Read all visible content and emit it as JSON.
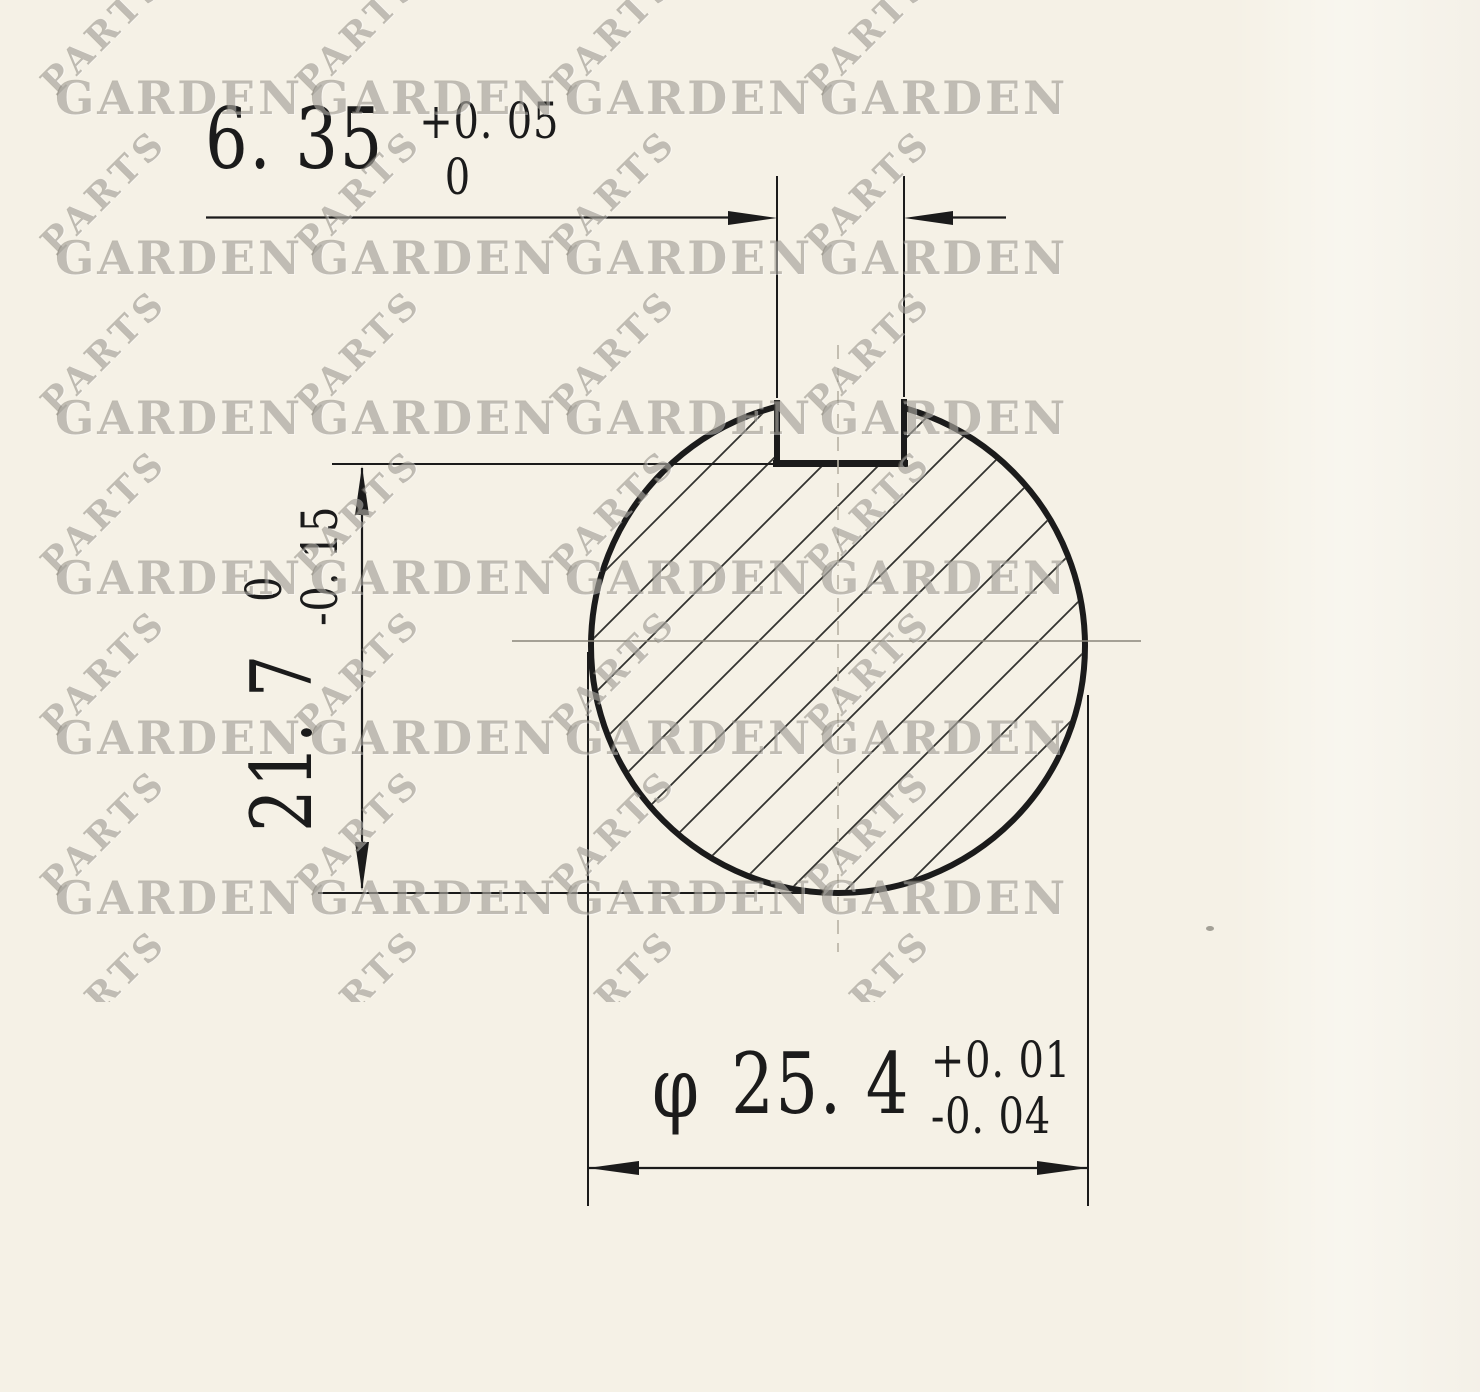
{
  "watermark": {
    "primary": "GARDEN",
    "secondary": "PARTS"
  },
  "dims": {
    "keyway_width": {
      "value": "6. 35",
      "tol_top": "+0. 05",
      "tol_bottom": "0"
    },
    "depth": {
      "value": "21. 7",
      "tol_top": "0",
      "tol_bottom": "-0. 15"
    },
    "diameter": {
      "prefix": "φ",
      "value": "25. 4",
      "tol_top": "+0. 01",
      "tol_bottom": "-0. 04"
    }
  },
  "colors": {
    "paper": "#f5f1e6",
    "ink": "#1b1b1b",
    "watermark": "#7a756a",
    "centerline": "#8a867a"
  }
}
